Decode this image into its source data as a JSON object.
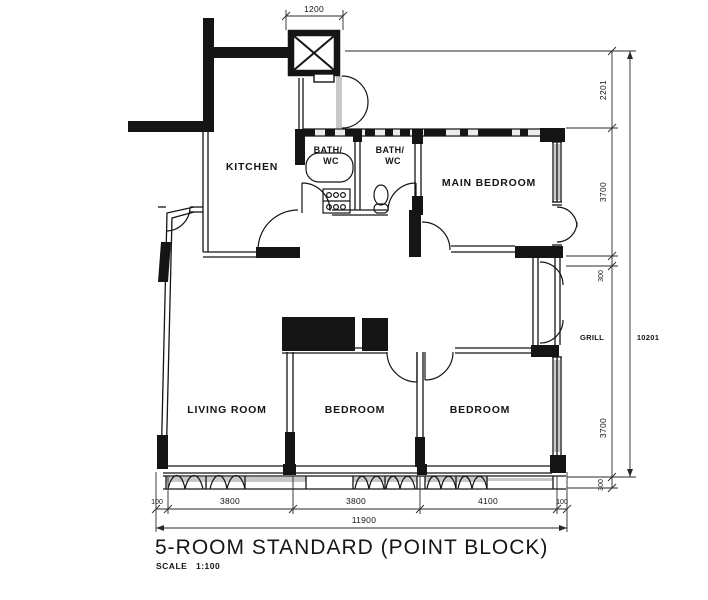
{
  "title": {
    "text": "5-ROOM STANDARD (POINT BLOCK)",
    "scale_label": "SCALE",
    "scale_value": "1:100"
  },
  "rooms": {
    "kitchen": "KITCHEN",
    "bath1": {
      "line1": "BATH/",
      "line2": "WC"
    },
    "bath2": {
      "line1": "BATH/",
      "line2": "WC"
    },
    "main_bedroom": "MAIN BEDROOM",
    "living_room": "LIVING ROOM",
    "bedroom_middle": "BEDROOM",
    "bedroom_right": "BEDROOM"
  },
  "annotations": {
    "grille": "GRILL"
  },
  "dimensions": {
    "top": {
      "lift_width": "1200"
    },
    "right": {
      "segments": [
        "2201",
        "3700",
        "300",
        "3700",
        "300"
      ],
      "total": "10201"
    },
    "bottom": {
      "segments": [
        "100",
        "3800",
        "3800",
        "4100",
        "100"
      ],
      "total": "11900"
    }
  },
  "colors": {
    "ink": "#151515",
    "background": "#ffffff",
    "shade": "#9a9a9a"
  }
}
